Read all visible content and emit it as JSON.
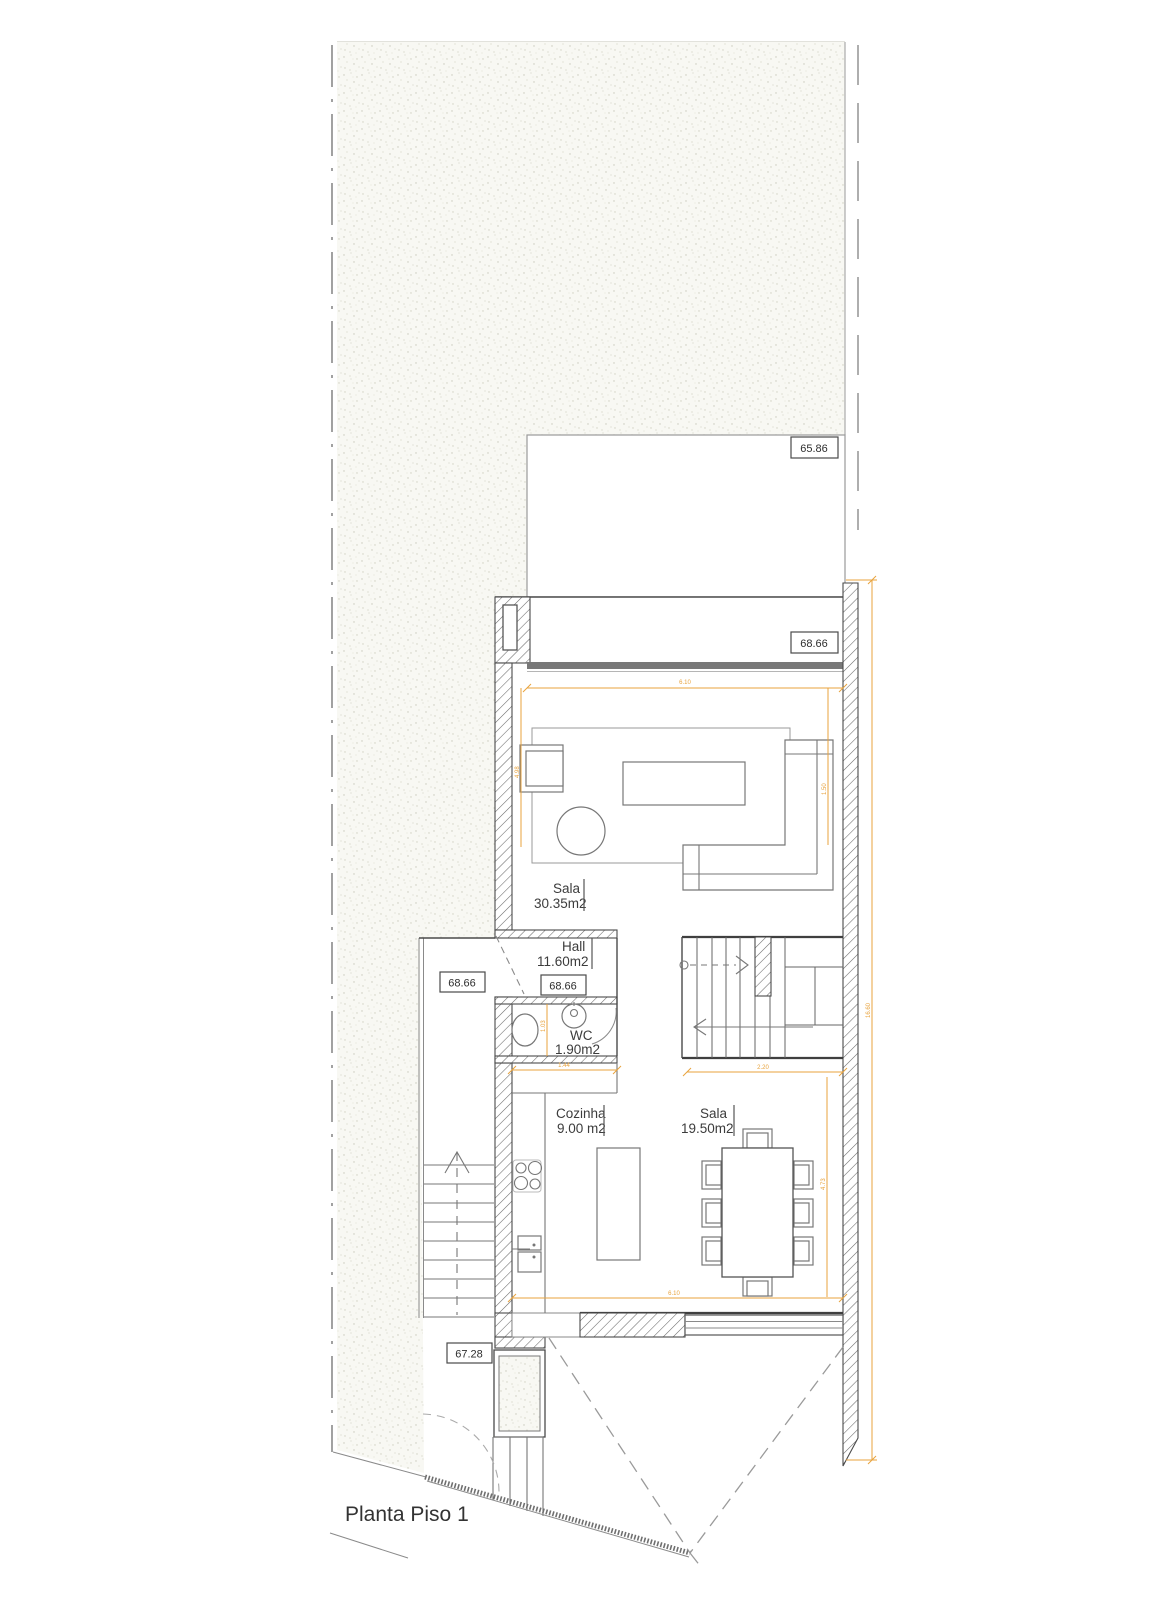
{
  "title": "Planta Piso 1",
  "rooms": {
    "living": {
      "name": "Sala",
      "area": "30.35m2"
    },
    "hall": {
      "name": "Hall",
      "area": "11.60m2"
    },
    "wc": {
      "name": "WC",
      "area": "1.90m2"
    },
    "kitchen": {
      "name": "Cozinha",
      "area": "9.00 m2"
    },
    "dining": {
      "name": "Sala",
      "area": "19.50m2"
    }
  },
  "elevations": {
    "garden": "65.86",
    "terrace": "68.66",
    "side_passage": "68.66",
    "hall": "68.66",
    "driveway": "67.28"
  },
  "dimensions": {
    "living_width": "6.10",
    "living_depth": "4.98",
    "sofa_depth": "1.50",
    "overall_depth": "16.60",
    "wc_depth": "1.03",
    "wc_width": "1.44",
    "stairs_width": "2.20",
    "dining_width": "6.10",
    "dining_depth": "4.73"
  },
  "colors": {
    "dimension": "#e8a33d",
    "wall_line": "#4a4a4a",
    "terrain_bg": "#f8f8f3"
  }
}
